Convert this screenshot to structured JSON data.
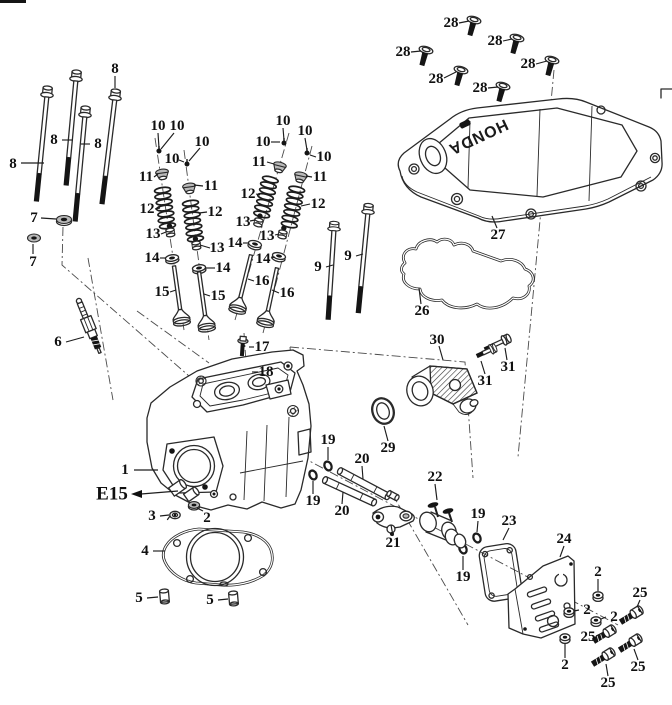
{
  "diagram": {
    "brand_text": "HONDA",
    "e15": {
      "text": "E15"
    },
    "background_color": "#ffffff",
    "line_color": "#2a2a2a",
    "callouts": [
      {
        "n": "8",
        "x": 13,
        "y": 164,
        "leader": [
          [
            21,
            163
          ],
          [
            44,
            163
          ]
        ]
      },
      {
        "n": "8",
        "x": 54,
        "y": 140,
        "leader": [
          [
            62,
            140
          ],
          [
            73,
            140
          ]
        ]
      },
      {
        "n": "8",
        "x": 98,
        "y": 144,
        "leader": [
          [
            90,
            144
          ],
          [
            81,
            144
          ]
        ]
      },
      {
        "n": "8",
        "x": 115,
        "y": 69,
        "leader": [
          [
            115,
            76
          ],
          [
            115,
            88
          ]
        ]
      },
      {
        "n": "7",
        "x": 34,
        "y": 218,
        "leader": [
          [
            41,
            218
          ],
          [
            56,
            219
          ]
        ]
      },
      {
        "n": "7",
        "x": 33,
        "y": 262,
        "leader": [
          [
            33,
            254
          ],
          [
            33,
            244
          ]
        ]
      },
      {
        "n": "6",
        "x": 58,
        "y": 342,
        "leader": [
          [
            66,
            342
          ],
          [
            84,
            337
          ]
        ]
      },
      {
        "n": "10",
        "x": 158,
        "y": 126,
        "leader": [
          [
            158,
            133
          ],
          [
            159,
            148
          ]
        ]
      },
      {
        "n": "10",
        "x": 177,
        "y": 126,
        "leader": [
          [
            174,
            133
          ],
          [
            161,
            149
          ]
        ]
      },
      {
        "n": "10",
        "x": 202,
        "y": 142,
        "leader": [
          [
            200,
            148
          ],
          [
            189,
            161
          ]
        ]
      },
      {
        "n": "10",
        "x": 172,
        "y": 159,
        "leader": [
          [
            179,
            160
          ],
          [
            184,
            162
          ]
        ]
      },
      {
        "n": "11",
        "x": 146,
        "y": 177,
        "leader": [
          [
            154,
            177
          ],
          [
            158,
            174
          ]
        ]
      },
      {
        "n": "11",
        "x": 211,
        "y": 186,
        "leader": [
          [
            203,
            186
          ],
          [
            194,
            185
          ]
        ]
      },
      {
        "n": "12",
        "x": 147,
        "y": 209,
        "leader": [
          [
            155,
            209
          ],
          [
            160,
            208
          ]
        ]
      },
      {
        "n": "12",
        "x": 215,
        "y": 212,
        "leader": [
          [
            207,
            212
          ],
          [
            199,
            213
          ]
        ]
      },
      {
        "n": "13",
        "x": 153,
        "y": 234,
        "leader": [
          [
            161,
            234
          ],
          [
            166,
            232
          ]
        ]
      },
      {
        "n": "13",
        "x": 217,
        "y": 248,
        "leader": [
          [
            210,
            248
          ],
          [
            200,
            245
          ]
        ]
      },
      {
        "n": "14",
        "x": 152,
        "y": 258,
        "leader": [
          [
            160,
            258
          ],
          [
            166,
            258
          ]
        ]
      },
      {
        "n": "14",
        "x": 223,
        "y": 268,
        "leader": [
          [
            215,
            268
          ],
          [
            205,
            268
          ]
        ]
      },
      {
        "n": "15",
        "x": 162,
        "y": 292,
        "leader": [
          [
            170,
            292
          ],
          [
            176,
            290
          ]
        ]
      },
      {
        "n": "15",
        "x": 218,
        "y": 296,
        "leader": [
          [
            210,
            296
          ],
          [
            204,
            294
          ]
        ]
      },
      {
        "n": "10",
        "x": 283,
        "y": 121,
        "leader": [
          [
            283,
            128
          ],
          [
            284,
            140
          ]
        ]
      },
      {
        "n": "10",
        "x": 263,
        "y": 142,
        "leader": [
          [
            271,
            142
          ],
          [
            280,
            142
          ]
        ]
      },
      {
        "n": "10",
        "x": 305,
        "y": 131,
        "leader": [
          [
            305,
            138
          ],
          [
            307,
            150
          ]
        ]
      },
      {
        "n": "10",
        "x": 324,
        "y": 157,
        "leader": [
          [
            316,
            157
          ],
          [
            310,
            155
          ]
        ]
      },
      {
        "n": "11",
        "x": 259,
        "y": 162,
        "leader": [
          [
            267,
            162
          ],
          [
            274,
            164
          ]
        ]
      },
      {
        "n": "11",
        "x": 320,
        "y": 177,
        "leader": [
          [
            312,
            177
          ],
          [
            306,
            176
          ]
        ]
      },
      {
        "n": "12",
        "x": 248,
        "y": 194,
        "leader": [
          [
            256,
            194
          ],
          [
            260,
            195
          ]
        ]
      },
      {
        "n": "12",
        "x": 318,
        "y": 204,
        "leader": [
          [
            310,
            204
          ],
          [
            301,
            206
          ]
        ]
      },
      {
        "n": "13",
        "x": 243,
        "y": 222,
        "leader": [
          [
            250,
            221
          ],
          [
            255,
            220
          ]
        ]
      },
      {
        "n": "13",
        "x": 267,
        "y": 236,
        "leader": [
          [
            275,
            235
          ],
          [
            279,
            234
          ]
        ]
      },
      {
        "n": "14",
        "x": 235,
        "y": 243,
        "leader": [
          [
            243,
            243
          ],
          [
            249,
            243
          ]
        ]
      },
      {
        "n": "14",
        "x": 263,
        "y": 259,
        "leader": [
          [
            271,
            258
          ],
          [
            275,
            257
          ]
        ]
      },
      {
        "n": "16",
        "x": 262,
        "y": 281,
        "leader": [
          [
            254,
            281
          ],
          [
            248,
            279
          ]
        ]
      },
      {
        "n": "16",
        "x": 287,
        "y": 293,
        "leader": [
          [
            279,
            293
          ],
          [
            272,
            290
          ]
        ]
      },
      {
        "n": "9",
        "x": 318,
        "y": 267,
        "leader": [
          [
            326,
            267
          ],
          [
            333,
            265
          ]
        ]
      },
      {
        "n": "9",
        "x": 348,
        "y": 256,
        "leader": [
          [
            356,
            256
          ],
          [
            363,
            254
          ]
        ]
      },
      {
        "n": "17",
        "x": 262,
        "y": 347,
        "leader": [
          [
            254,
            347
          ],
          [
            249,
            347
          ]
        ]
      },
      {
        "n": "18",
        "x": 266,
        "y": 372,
        "leader": [
          [
            258,
            372
          ],
          [
            252,
            372
          ]
        ]
      },
      {
        "n": "1",
        "x": 125,
        "y": 470,
        "leader": [
          [
            134,
            470
          ],
          [
            158,
            470
          ]
        ]
      },
      {
        "n": "3",
        "x": 152,
        "y": 516,
        "leader": [
          [
            160,
            516
          ],
          [
            169,
            515
          ]
        ]
      },
      {
        "n": "2",
        "x": 207,
        "y": 518,
        "leader": [
          [
            203,
            511
          ],
          [
            197,
            508
          ]
        ]
      },
      {
        "n": "4",
        "x": 145,
        "y": 551,
        "leader": [
          [
            153,
            551
          ],
          [
            165,
            551
          ]
        ]
      },
      {
        "n": "5",
        "x": 139,
        "y": 598,
        "leader": [
          [
            147,
            598
          ],
          [
            158,
            597
          ]
        ]
      },
      {
        "n": "5",
        "x": 210,
        "y": 600,
        "leader": [
          [
            218,
            600
          ],
          [
            228,
            599
          ]
        ]
      },
      {
        "n": "28",
        "x": 451,
        "y": 23,
        "leader": [
          [
            459,
            23
          ],
          [
            469,
            21
          ]
        ]
      },
      {
        "n": "28",
        "x": 495,
        "y": 41,
        "leader": [
          [
            503,
            41
          ],
          [
            512,
            39
          ]
        ]
      },
      {
        "n": "28",
        "x": 403,
        "y": 52,
        "leader": [
          [
            411,
            52
          ],
          [
            421,
            51
          ]
        ]
      },
      {
        "n": "28",
        "x": 528,
        "y": 64,
        "leader": [
          [
            536,
            64
          ],
          [
            547,
            61
          ]
        ]
      },
      {
        "n": "28",
        "x": 436,
        "y": 79,
        "leader": [
          [
            444,
            78
          ],
          [
            456,
            72
          ]
        ]
      },
      {
        "n": "28",
        "x": 480,
        "y": 88,
        "leader": [
          [
            488,
            88
          ],
          [
            498,
            87
          ]
        ]
      },
      {
        "n": "27",
        "x": 498,
        "y": 235,
        "leader": [
          [
            497,
            228
          ],
          [
            492,
            216
          ]
        ]
      },
      {
        "n": "26",
        "x": 422,
        "y": 311,
        "leader": [
          [
            421,
            304
          ],
          [
            419,
            288
          ]
        ]
      },
      {
        "n": "30",
        "x": 437,
        "y": 340,
        "leader": [
          [
            439,
            346
          ],
          [
            443,
            360
          ]
        ]
      },
      {
        "n": "31",
        "x": 508,
        "y": 367,
        "leader": [
          [
            507,
            360
          ],
          [
            505,
            348
          ]
        ]
      },
      {
        "n": "31",
        "x": 485,
        "y": 381,
        "leader": [
          [
            485,
            374
          ],
          [
            481,
            361
          ]
        ]
      },
      {
        "n": "29",
        "x": 388,
        "y": 448,
        "leader": [
          [
            388,
            441
          ],
          [
            384,
            426
          ]
        ]
      },
      {
        "n": "19",
        "x": 328,
        "y": 440,
        "leader": [
          [
            328,
            447
          ],
          [
            328,
            460
          ]
        ]
      },
      {
        "n": "19",
        "x": 313,
        "y": 501,
        "leader": [
          [
            313,
            494
          ],
          [
            313,
            481
          ]
        ]
      },
      {
        "n": "19",
        "x": 478,
        "y": 514,
        "leader": [
          [
            478,
            521
          ],
          [
            477,
            532
          ]
        ]
      },
      {
        "n": "19",
        "x": 463,
        "y": 577,
        "leader": [
          [
            463,
            570
          ],
          [
            463,
            556
          ]
        ]
      },
      {
        "n": "20",
        "x": 362,
        "y": 459,
        "leader": [
          [
            362,
            466
          ],
          [
            363,
            479
          ]
        ]
      },
      {
        "n": "20",
        "x": 342,
        "y": 511,
        "leader": [
          [
            342,
            504
          ],
          [
            343,
            492
          ]
        ]
      },
      {
        "n": "21",
        "x": 393,
        "y": 543,
        "leader": [
          [
            393,
            536
          ],
          [
            391,
            525
          ]
        ]
      },
      {
        "n": "22",
        "x": 435,
        "y": 477,
        "leader": [
          [
            435,
            484
          ],
          [
            437,
            500
          ]
        ]
      },
      {
        "n": "23",
        "x": 509,
        "y": 521,
        "leader": [
          [
            509,
            528
          ],
          [
            503,
            540
          ]
        ]
      },
      {
        "n": "24",
        "x": 564,
        "y": 539,
        "leader": [
          [
            564,
            546
          ],
          [
            560,
            557
          ]
        ]
      },
      {
        "n": "2",
        "x": 598,
        "y": 572,
        "leader": [
          [
            598,
            579
          ],
          [
            598,
            591
          ]
        ]
      },
      {
        "n": "2",
        "x": 587,
        "y": 610,
        "leader": [
          [
            579,
            610
          ],
          [
            574,
            611
          ]
        ]
      },
      {
        "n": "2",
        "x": 614,
        "y": 617,
        "leader": [
          [
            606,
            617
          ],
          [
            601,
            619
          ]
        ]
      },
      {
        "n": "2",
        "x": 565,
        "y": 665,
        "leader": [
          [
            565,
            658
          ],
          [
            565,
            643
          ]
        ]
      },
      {
        "n": "25",
        "x": 640,
        "y": 593,
        "leader": [
          [
            640,
            600
          ],
          [
            637,
            607
          ]
        ]
      },
      {
        "n": "25",
        "x": 588,
        "y": 637,
        "leader": [
          [
            596,
            636
          ],
          [
            602,
            633
          ]
        ]
      },
      {
        "n": "25",
        "x": 638,
        "y": 667,
        "leader": [
          [
            638,
            660
          ],
          [
            634,
            649
          ]
        ]
      },
      {
        "n": "25",
        "x": 608,
        "y": 683,
        "leader": [
          [
            608,
            676
          ],
          [
            606,
            664
          ]
        ]
      }
    ],
    "axis_lines": [
      {
        "pts": [
          [
            63,
            227
          ],
          [
            62,
            265
          ],
          [
            205,
            390
          ]
        ]
      },
      {
        "pts": [
          [
            88,
            258
          ],
          [
            113,
            400
          ]
        ]
      },
      {
        "pts": [
          [
            137,
            311
          ],
          [
            209,
            363
          ]
        ]
      },
      {
        "pts": [
          [
            554,
            70
          ],
          [
            518,
            457
          ]
        ]
      },
      {
        "pts": [
          [
            290,
            347
          ],
          [
            465,
            362
          ],
          [
            473,
            478
          ]
        ]
      },
      {
        "pts": [
          [
            290,
            347
          ],
          [
            300,
            456
          ]
        ]
      },
      {
        "pts": [
          [
            300,
            456
          ],
          [
            618,
            625
          ]
        ]
      },
      {
        "pts": [
          [
            390,
            490
          ],
          [
            468,
            625
          ]
        ]
      },
      {
        "pts": [
          [
            155,
            138
          ],
          [
            184,
            330
          ]
        ]
      },
      {
        "pts": [
          [
            184,
            150
          ],
          [
            209,
            340
          ]
        ]
      },
      {
        "pts": [
          [
            289,
            133
          ],
          [
            235,
            320
          ]
        ]
      },
      {
        "pts": [
          [
            312,
            146
          ],
          [
            263,
            333
          ]
        ]
      },
      {
        "pts": [
          [
            244,
            333
          ],
          [
            248,
            392
          ]
        ]
      }
    ]
  }
}
